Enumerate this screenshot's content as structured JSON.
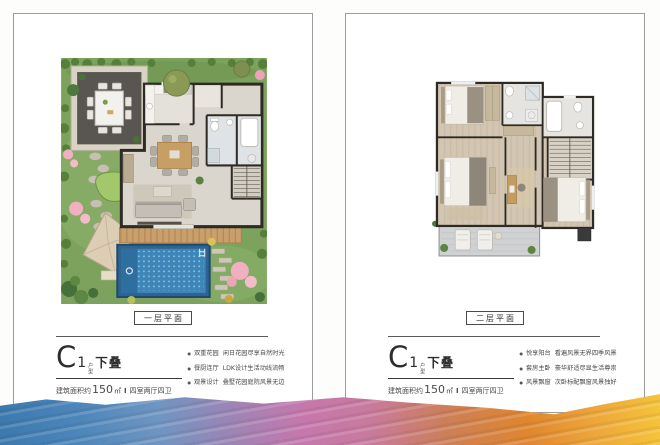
{
  "colors": {
    "card_border": "#9c9c9c",
    "wall_dark": "#2e2a26",
    "garden_green": "#7ca25d",
    "pool_blue": "#3f86b8",
    "band_blue": "#3c79ae",
    "band_pink": "#c678ad",
    "band_orange": "#e0862f",
    "band_gold": "#f5c33b"
  },
  "cards": {
    "left": {
      "floor_label": "一层平面",
      "title": {
        "letter": "C",
        "number": "1",
        "small_top": "户",
        "small_bottom": "型",
        "suffix": "下叠"
      },
      "area": {
        "prefix": "建筑面积约",
        "value": "150",
        "unit": "㎡",
        "divider": "Ⅰ",
        "rooms": "四室两厅四卫"
      },
      "bullets": [
        {
          "tag": "双重花园",
          "desc": "闲日花园尽享自然时光"
        },
        {
          "tag": "餐厨连厅",
          "desc": "LDK设计生活动线流畅"
        },
        {
          "tag": "观景设计",
          "desc": "叠墅花园庭院风景无边"
        }
      ]
    },
    "right": {
      "floor_label": "二层平面",
      "title": {
        "letter": "C",
        "number": "1",
        "small_top": "户",
        "small_bottom": "型",
        "suffix": "下叠"
      },
      "area": {
        "prefix": "建筑面积约",
        "value": "150",
        "unit": "㎡",
        "divider": "Ⅰ",
        "rooms": "四室两厅四卫"
      },
      "bullets": [
        {
          "tag": "悦享阳台",
          "desc": "看遍风景无界四季风景"
        },
        {
          "tag": "套房主卧",
          "desc": "豪华舒适尽显生活尊崇"
        },
        {
          "tag": "风景飘窗",
          "desc": "次卧标配飘窗风景独好"
        }
      ]
    }
  }
}
